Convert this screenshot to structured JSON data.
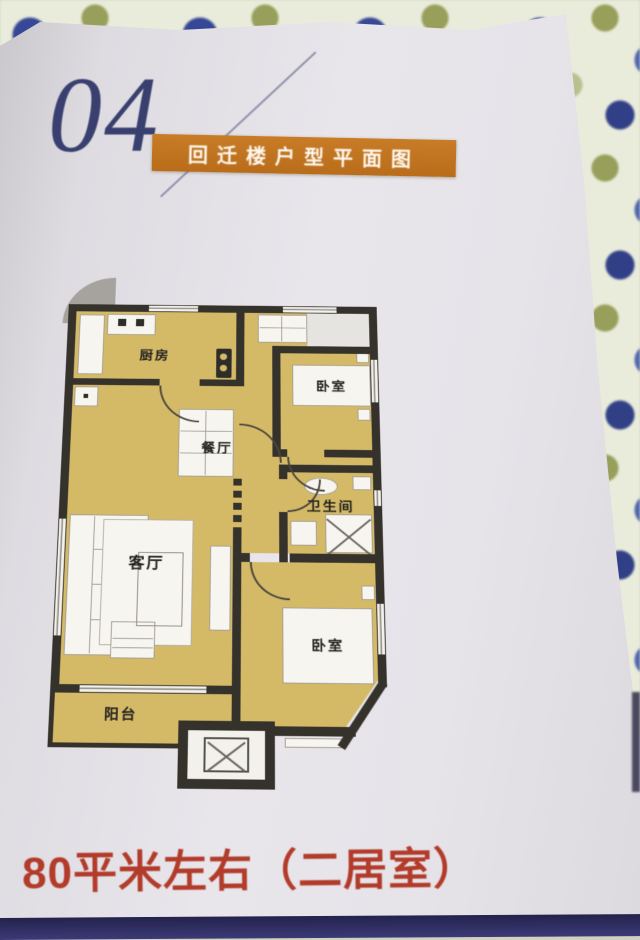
{
  "page": {
    "section_number": "04",
    "banner_title": "回迁楼户型平面图",
    "caption": "80平米左右（二居室）"
  },
  "floorplan": {
    "rooms": {
      "kitchen": {
        "label": "厨房"
      },
      "bedroom_top": {
        "label": "卧室"
      },
      "dining": {
        "label": "餐厅"
      },
      "bathroom": {
        "label": "卫生间"
      },
      "living": {
        "label": "客厅"
      },
      "bedroom_bottom": {
        "label": "卧室"
      },
      "balcony": {
        "label": "阳台"
      }
    },
    "colors": {
      "floor": "#d6ba60",
      "wall": "#35322c",
      "fixture": "#f7f5f0"
    }
  },
  "colors": {
    "banner_bg": "#b96d1a",
    "banner_text": "#fdf8ef",
    "section_number": "#39406f",
    "caption_text": "#b23b2a",
    "fabric_base": "#e9ecd9",
    "bottom_strip": "#312f6b"
  }
}
